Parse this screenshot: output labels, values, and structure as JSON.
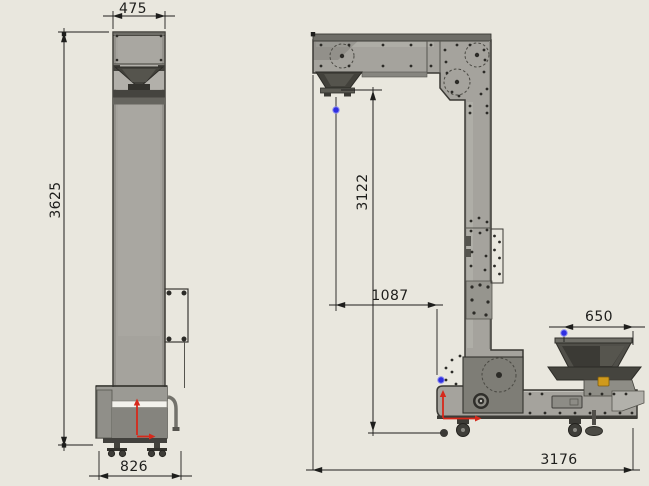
{
  "drawing": {
    "type": "cad-2d-drawing",
    "subject": "z-type bucket elevator, two orthographic views with dimensions",
    "views": {
      "front": {
        "dimensions": {
          "top_width": "475",
          "overall_height": "3625",
          "base_width": "826"
        }
      },
      "side": {
        "dimensions": {
          "discharge_height": "3122",
          "discharge_reach": "1087",
          "infeed_width": "650",
          "overall_length": "3176"
        }
      }
    },
    "icons": [
      {
        "name": "selection-point",
        "glyph": "blue-dot",
        "count": 3
      },
      {
        "name": "origin-arrow",
        "glyph": "red-arrow",
        "count": 2
      },
      {
        "name": "pulley-circle",
        "glyph": "dashed-circle",
        "count": 4
      }
    ]
  },
  "colors": {
    "background": "#e9e7de",
    "machine_body": "#a5a39d",
    "machine_light": "#b7b5af",
    "machine_mid": "#6e6d67",
    "machine_dark": "#47463f",
    "machine_deep": "#33322d",
    "outline": "#3a3934",
    "dim_line": "#1e1e1c",
    "white_stripe": "#f3f2ec",
    "selection_blue": "#2f2fe2",
    "origin_red": "#d6291b",
    "accent_yellow": "#d09a1c"
  }
}
